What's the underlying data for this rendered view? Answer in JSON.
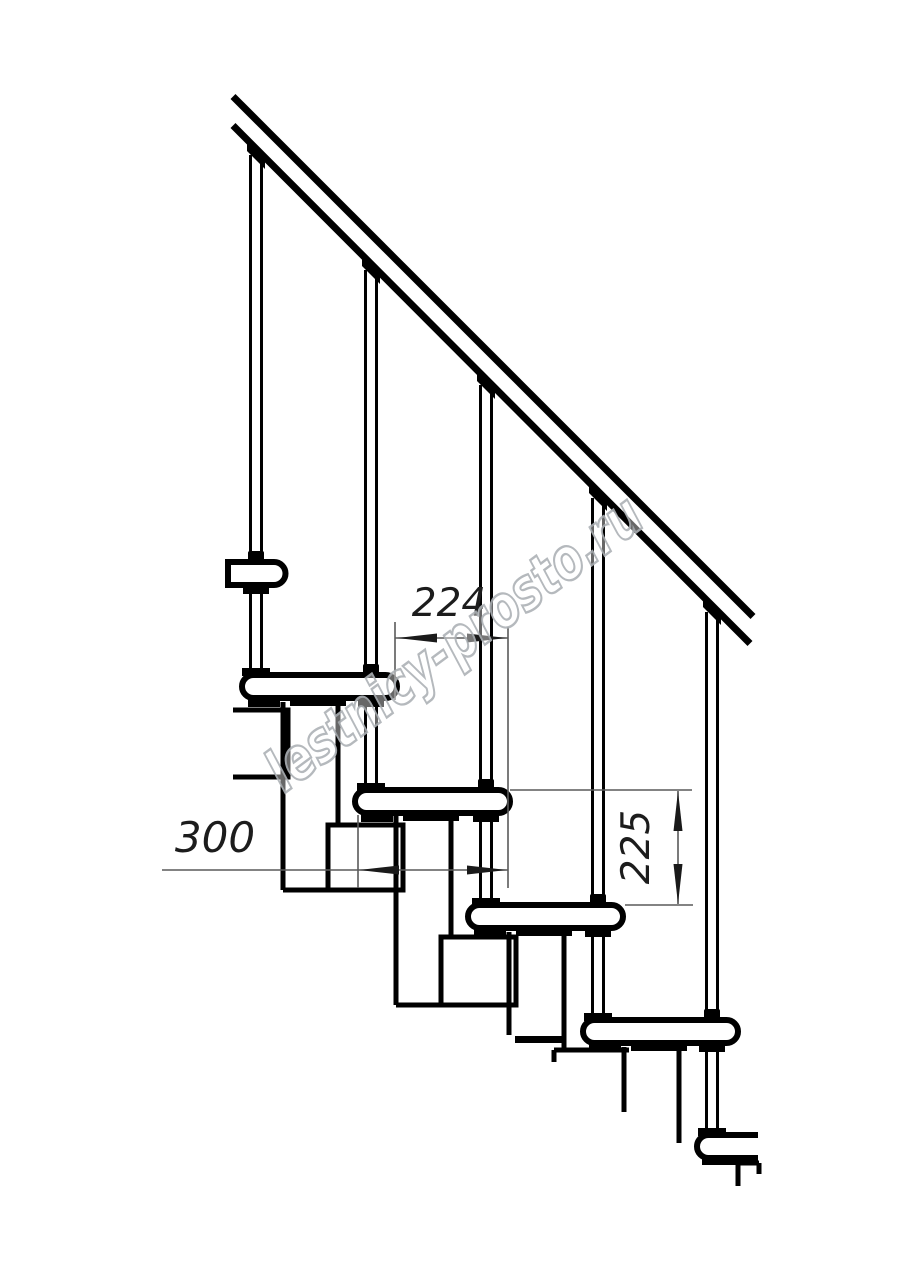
{
  "dimensions": {
    "going_224": {
      "value": "224",
      "orientation": "horizontal"
    },
    "module_depth_300": {
      "value": "300",
      "orientation": "horizontal"
    },
    "rise_225": {
      "value": "225",
      "orientation": "vertical"
    }
  },
  "watermark": {
    "text": "lestnicy-prosto.ru",
    "outline_color": "#adb2b6"
  },
  "colors": {
    "background": "#ffffff",
    "drawing_line": "#000000",
    "dimension_line": "#4f4f4f",
    "dimension_text": "#1c1c1c"
  }
}
